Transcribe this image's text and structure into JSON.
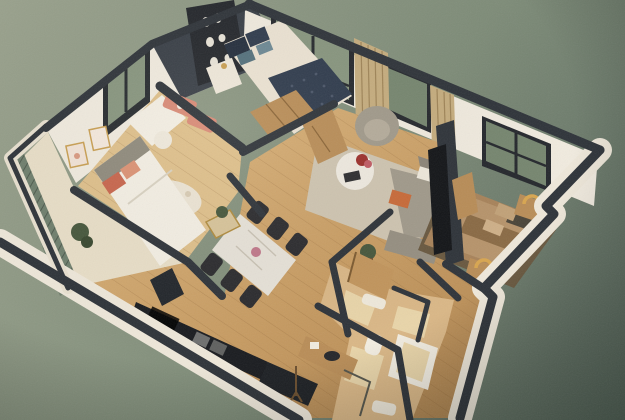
{
  "meta": {
    "description": "Photograph of a 3D isometric cutaway floor-plan render of an apartment on a textured sage-green backdrop",
    "view": "isometric cutaway 3D floor plan, no visible text"
  },
  "palette": {
    "bg_light": "#9aa28d",
    "bg_mid": "#7e8c78",
    "bg_dark": "#55645a",
    "wall_cream": "#f1ebdf",
    "wall_cream_dim": "#e4dbc9",
    "wall_cap": "#2e3339",
    "wall_cap_dark": "#22262b",
    "accent_wall": "#383e46",
    "shelf_unit": "#23262b",
    "wood_light": "#d9b178",
    "wood_mid": "#c89c62",
    "wood_deep": "#b08550",
    "wood_furniture": "#b98d57",
    "door_wood": "#c2955c",
    "tile": "#dab786",
    "tile_light": "#e9d5a9",
    "glass_green": "#87957e",
    "glass_green_dark": "#76866f",
    "curtain": "#c6ad7e",
    "navy": "#2e3a4c",
    "navy_dark": "#232d3c",
    "teal_pillow": "#53707c",
    "duvet_cream": "#ece3d3",
    "white_soft": "#f4efe4",
    "coral": "#c8654c",
    "coral_light": "#dc9274",
    "shelf_coral": "#d98a76",
    "grey_sofa": "#a19a8b",
    "grey_sofa_dark": "#8c8578",
    "rug_beige": "#cfc5b1",
    "rug_white": "#ece4d4",
    "marble": "#e7e2d8",
    "chair_black": "#2b2b2e",
    "counter_black": "#191b1f",
    "brass": "#c99f52",
    "plant_green": "#46573c",
    "orange_pillow": "#c96a38",
    "bed3_brown": "#a8835a",
    "bed3_dark": "#8a6a44",
    "rug3_dark": "#69583f",
    "balcony_slats": "#6f7f6d"
  },
  "scene": {
    "rooms": [
      {
        "name": "master-bedroom",
        "furniture": [
          "double bed with navy tufted throw",
          "navy and teal pillows",
          "charcoal shelving accent wall",
          "white nightstand",
          "wood wardrobe",
          "tall window"
        ]
      },
      {
        "name": "second-bedroom",
        "furniture": [
          "white bed with coral pillows",
          "desk with white stool",
          "coral wall shelves",
          "dotted round rug",
          "two framed artworks",
          "window"
        ]
      },
      {
        "name": "living-room",
        "furniture": [
          "grey armchair",
          "round white coffee table with red flowers",
          "grey sofa with orange pillow",
          "beige area rug",
          "tv partition wall",
          "wood media console",
          "tan curtains",
          "two windows"
        ]
      },
      {
        "name": "third-bedroom",
        "furniture": [
          "brown double bed",
          "dark area rug",
          "two nightstands with brass arc lamps",
          "window"
        ]
      },
      {
        "name": "dining-area",
        "furniture": [
          "marble dining table",
          "six black chairs",
          "brass console with plant"
        ]
      },
      {
        "name": "kitchen",
        "furniture": [
          "black countertop with double sink and cooktop",
          "dark island block",
          "wood cabinet fronts"
        ]
      },
      {
        "name": "bathroom",
        "furniture": [
          "bathtub",
          "toilet",
          "wood vanity with dark basin",
          "glass shower screen",
          "open wood door",
          "white bath mats"
        ]
      },
      {
        "name": "balcony",
        "furniture": [
          "slatted railing",
          "potted plant"
        ]
      }
    ]
  }
}
